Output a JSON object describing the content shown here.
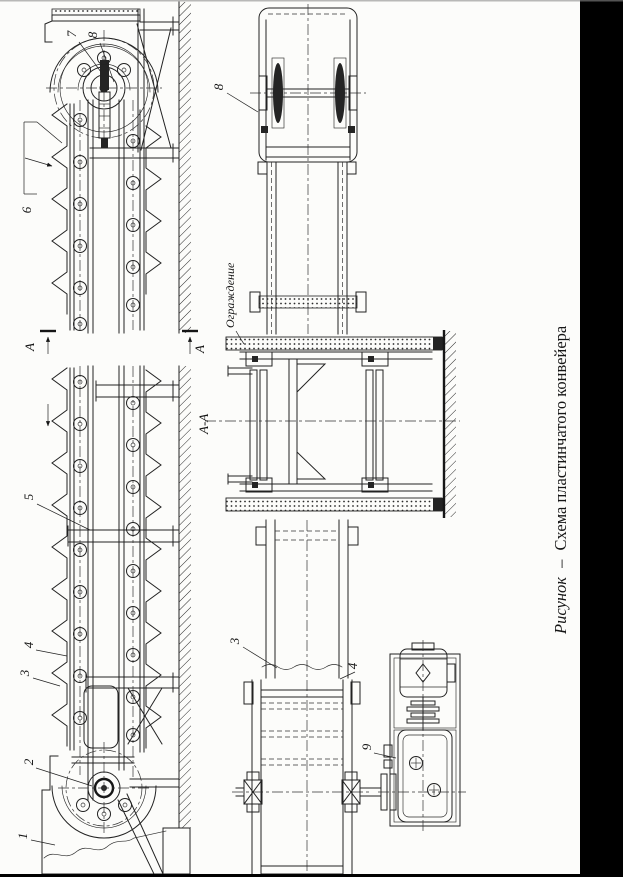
{
  "caption": {
    "prefix": "Рисунок",
    "dash": "–",
    "title": "Схема пластинчатого конвейера"
  },
  "labels": {
    "n1": "1",
    "n2": "2",
    "n3": "3",
    "n4": "4",
    "n5": "5",
    "n6": "6",
    "n7": "7",
    "n8": "8",
    "n9": "9",
    "section_letter": "А",
    "section_view": "А-А",
    "guard_note": "Ограждение"
  },
  "colors": {
    "ink": "#222222",
    "paper": "#fcfcfa",
    "scan_band": "#000000"
  }
}
